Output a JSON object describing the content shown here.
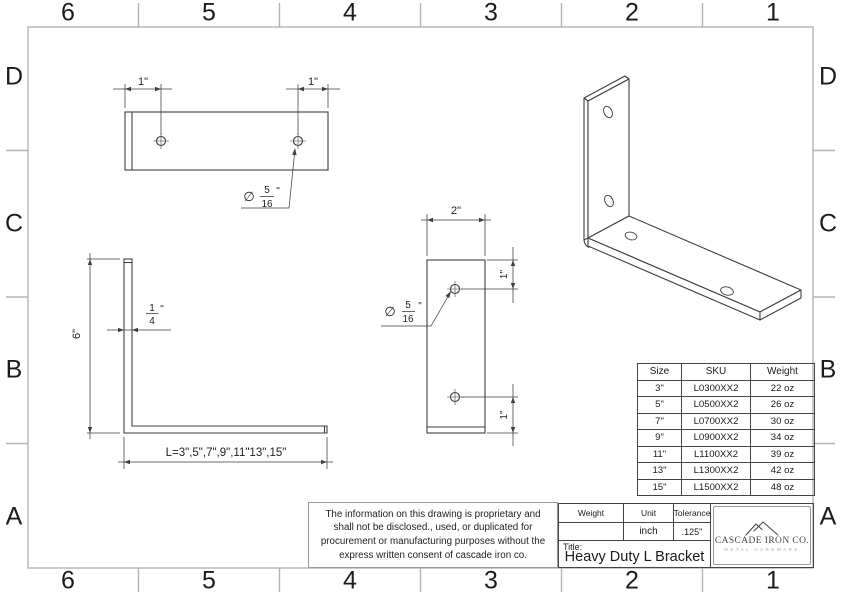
{
  "zones": {
    "cols": [
      "6",
      "5",
      "4",
      "3",
      "2",
      "1"
    ],
    "rows": [
      "D",
      "C",
      "B",
      "A"
    ]
  },
  "views": {
    "top": {
      "dim_left": "1\"",
      "dim_right": "1\"",
      "callout": {
        "sym": "∅",
        "num": "5",
        "den": "16",
        "unit": "\""
      }
    },
    "side": {
      "height": "6\"",
      "thick": {
        "num": "1",
        "den": "4",
        "unit": "\""
      },
      "length": "L=3\",5\",7\",9\",11\"13\",15\""
    },
    "front": {
      "width": "2\"",
      "dim_top": "1\"",
      "dim_bottom": "1\"",
      "callout": {
        "sym": "∅",
        "num": "5",
        "den": "16",
        "unit": "\""
      }
    }
  },
  "note": "The information on this drawing is proprietary and shall not be disclosed., used, or duplicated for procurement or manufacturing purposes without the express written consent of cascade iron co.",
  "size_table": {
    "headers": [
      "Size",
      "SKU",
      "Weight"
    ],
    "rows": [
      [
        "3\"",
        "L0300XX2",
        "22 oz"
      ],
      [
        "5\"",
        "L0500XX2",
        "26 oz"
      ],
      [
        "7\"",
        "L0700XX2",
        "30 oz"
      ],
      [
        "9\"",
        "L0900XX2",
        "34 oz"
      ],
      [
        "11\"",
        "L1100XX2",
        "39 oz"
      ],
      [
        "13\"",
        "L1300XX2",
        "42 oz"
      ],
      [
        "15\"",
        "L1500XX2",
        "48 oz"
      ]
    ]
  },
  "title_block": {
    "weight_label": "Weight",
    "unit_label": "Unit",
    "tolerance_label": "Tolerance",
    "weight_value": "",
    "unit_value": "inch",
    "tolerance_value": ".125\"",
    "title_label": "Title:",
    "title": "Heavy Duty L Bracket"
  },
  "logo": {
    "company": "CASCADE IRON CO.",
    "tagline": "METAL HARDWARE"
  }
}
